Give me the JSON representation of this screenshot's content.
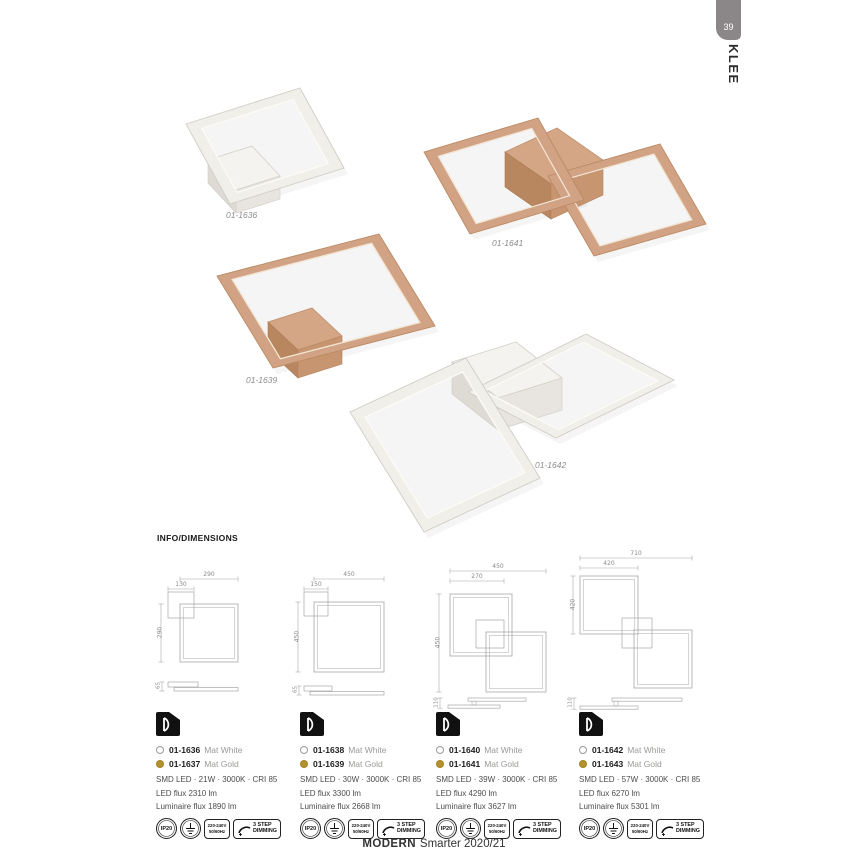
{
  "header": {
    "page_number": "39",
    "series": "KLEE",
    "info_title": "INFO/DIMENSIONS"
  },
  "products": [
    {
      "label": "01-1636"
    },
    {
      "label": "01-1641"
    },
    {
      "label": "01-1639"
    },
    {
      "label": "01-1642"
    }
  ],
  "drawings": [
    {
      "dim_top": "290",
      "dim_inner": "130",
      "dim_left": "290",
      "dim_side": "65"
    },
    {
      "dim_top": "450",
      "dim_inner": "150",
      "dim_left": "450",
      "dim_side": "65"
    },
    {
      "dim_top": "450",
      "dim_inner": "270",
      "dim_left": "450",
      "dim_side": "110"
    },
    {
      "dim_top": "710",
      "dim_inner": "420",
      "dim_left": "420",
      "dim_side": "110"
    }
  ],
  "specs": [
    {
      "white_code": "01-1636",
      "white_finish": "Mat White",
      "gold_code": "01-1637",
      "gold_finish": "Mat Gold",
      "led": "SMD LED · 21W · 3000K · CRI 85",
      "flux": "LED flux 2310 lm",
      "lum": "Luminaire flux 1890 lm"
    },
    {
      "white_code": "01-1638",
      "white_finish": "Mat White",
      "gold_code": "01-1639",
      "gold_finish": "Mat Gold",
      "led": "SMD LED · 30W · 3000K · CRI 85",
      "flux": "LED flux 3300 lm",
      "lum": "Luminaire flux 2668 lm"
    },
    {
      "white_code": "01-1640",
      "white_finish": "Mat White",
      "gold_code": "01-1641",
      "gold_finish": "Mat Gold",
      "led": "SMD LED · 39W · 3000K · CRI 85",
      "flux": "LED flux 4290 lm",
      "lum": "Luminaire flux 3627 lm"
    },
    {
      "white_code": "01-1642",
      "white_finish": "Mat White",
      "gold_code": "01-1643",
      "gold_finish": "Mat Gold",
      "led": "SMD LED · 57W · 3000K · CRI 85",
      "flux": "LED flux 6270 lm",
      "lum": "Luminaire flux 5301 lm"
    }
  ],
  "badges": {
    "ip": "IP20",
    "volt1": "220-240V",
    "volt2": "50/60Hz",
    "dim1": "3 STEP",
    "dim2": "DIMMING"
  },
  "footer": {
    "brand": "MODERN",
    "tagline": "Smarter 2020/21"
  },
  "colors": {
    "gold_frame": "#d2a284",
    "white_frame": "#f1efea",
    "gold_dot": "#b29130",
    "tab_gray": "#8b8789"
  }
}
